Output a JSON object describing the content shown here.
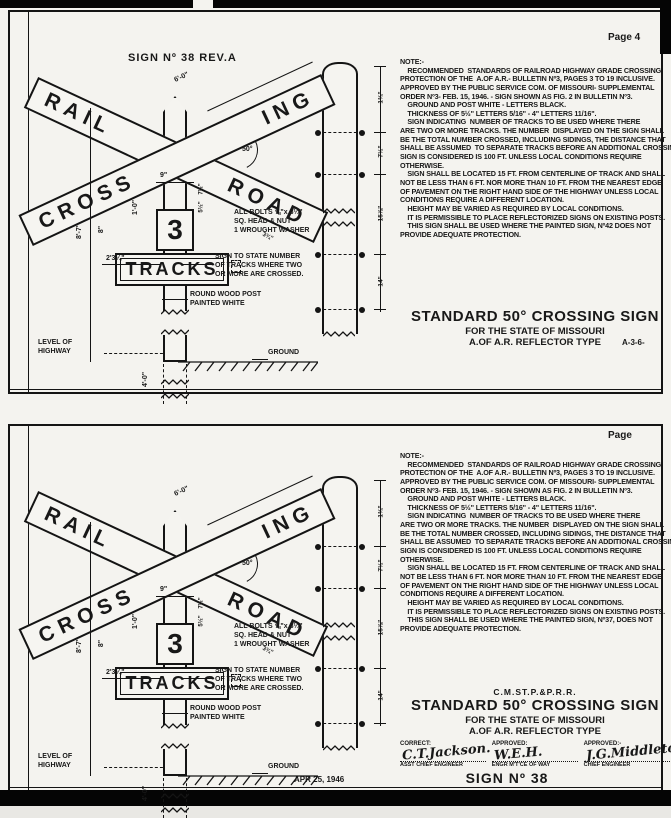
{
  "page_bg": "#f4f3ef",
  "ink": "#141414",
  "panels": [
    {
      "page_label": "Page 4",
      "heading": "SIGN Nº 38 REV.A",
      "crossbuck": {
        "rail": "RAIL",
        "road": "ROAD",
        "cross": "CROSS",
        "ing": "ING",
        "track_count": "3",
        "tracks": "TRACKS"
      },
      "dims": {
        "arm": "6'-0\"",
        "angle": "50°",
        "post_width": "9\"",
        "offset8": "8\"",
        "height": "8'-7\"",
        "base": "2'3¼\"",
        "plate": "1'-0\"",
        "m1": "7½\"",
        "m2": "5½\"",
        "road_end": "3¾\"",
        "below_ground": "4'-0\"",
        "s1": "1¾\"",
        "s2": "7½\"",
        "s3": "15⅞\"",
        "s4": "14\""
      },
      "labels": {
        "bolts": "ALL BOLTS ⅝\"x 8¼\"\nSQ. HEAD & NUT\n1 WROUGHT WASHER",
        "tracks_note": "SIGN TO STATE NUMBER\nOF TRACKS WHERE TWO\nOR MORE ARE CROSSED.",
        "post": "ROUND WOOD POST\nPAINTED WHITE",
        "level": "LEVEL OF\nHIGHWAY",
        "ground": "GROUND"
      },
      "notes": "NOTE:-\n    RECOMMENDED  STANDARDS OF RAILROAD HIGHWAY GRADE CROSSING\nPROTECTION OF THE  A.OF A.R.- BULLETIN Nº3, PAGES 3 TO 19 INCLUSIVE.\nAPPROVED BY THE PUBLIC SERVICE COM. OF MISSOURI- SUPPLEMENTAL\nORDER Nº3- FEB. 15, 1946. - SIGN SHOWN AS FIG. 2 IN BULLETIN Nº3.\n    GROUND AND POST WHITE - LETTERS BLACK.\n    THICKNESS OF 5½\" LETTERS 5/16\" - 4\" LETTERS 11/16\".\n    SIGN INDICATING  NUMBER OF TRACKS TO BE USED WHERE THERE\nARE TWO OR MORE TRACKS. THE NUMBER  DISPLAYED ON THE SIGN SHALL\nBE THE TOTAL NUMBER CROSSED, INCLUDING SIDINGS, THE DISTANCE THAT\nSHALL BE ASSUMED  TO SEPARATE TRACKS BEFORE AN ADDITIONAL CROSSING\nSIGN IS CONSIDERED IS 100 FT. UNLESS LOCAL CONDITIONS REQUIRE\nOTHERWISE.\n    SIGN SHALL BE LOCATED 15 FT. FROM CENTERLINE OF TRACK AND SHALL\nNOT BE LESS THAN 6 FT. NOR MORE THAN 10 FT. FROM THE NEAREST EDGE\nOF PAVEMENT ON THE RIGHT HAND SIDE OF THE HIGHWAY UNLESS LOCAL\nCONDITIONS REQUIRE A DIFFERENT LOCATION.\n    HEIGHT MAY BE VARIED AS REQUIRED BY LOCAL CONDITIONS.\n    IT IS PERMISSIBLE TO PLACE REFLECTORIZED SIGNS ON EXISTING POSTS.\n    THIS SIGN SHALL BE USED WHERE THE PAINTED SIGN, Nº42 DOES NOT\nPROVIDE ADEQUATE PROTECTION.",
      "title": {
        "rr": "",
        "line1": "STANDARD 50° CROSSING SIGN",
        "line2": "FOR THE STATE OF MISSOURI",
        "line3": "A.OF A.R. REFLECTOR TYPE",
        "code": "A-3-6-"
      }
    },
    {
      "page_label": "Page",
      "heading": "",
      "crossbuck": {
        "rail": "RAIL",
        "road": "ROAD",
        "cross": "CROSS",
        "ing": "ING",
        "track_count": "3",
        "tracks": "TRACKS"
      },
      "dims": {
        "arm": "6'-0\"",
        "angle": "50°",
        "post_width": "9\"",
        "offset8": "8\"",
        "height": "8'-7\"",
        "base": "2'3¼\"",
        "plate": "1'-0\"",
        "m1": "7½\"",
        "m2": "5½\"",
        "road_end": "3¾\"",
        "below_ground": "4'-0\"",
        "s1": "1¾\"",
        "s2": "7½\"",
        "s3": "15⅞\"",
        "s4": "14\""
      },
      "labels": {
        "bolts": "ALL BOLTS ⅝\"x 8¼\"\nSQ. HEAD & NUT\n1 WROUGHT WASHER",
        "tracks_note": "SIGN TO STATE NUMBER\nOF TRACKS WHERE TWO\nOR MORE ARE CROSSED.",
        "post": "ROUND WOOD POST\nPAINTED WHITE",
        "level": "LEVEL OF\nHIGHWAY",
        "ground": "GROUND"
      },
      "notes": "NOTE:-\n    RECOMMENDED  STANDARDS OF RAILROAD HIGHWAY GRADE CROSSING\nPROTECTION OF THE  A.OF A.R.- BULLETIN Nº3, PAGES 3 TO 19 INCLUSIVE.\nAPPROVED BY THE PUBLIC SERVICE COM. OF MISSOURI- SUPPLEMENTAL\nORDER Nº3- FEB. 15, 1946. - SIGN SHOWN AS FIG. 2 IN BULLETIN Nº3.\n    GROUND AND POST WHITE - LETTERS BLACK.\n    THICKNESS OF 5½\" LETTERS 5/16\" - 4\" LETTERS 11/16\".\n    SIGN INDICATING  NUMBER OF TRACKS TO BE USED WHERE THERE\nARE TWO OR MORE TRACKS. THE NUMBER  DISPLAYED ON THE SIGN SHALL\nBE THE TOTAL NUMBER CROSSED, INCLUDING SIDINGS, THE DISTANCE THAT\nSHALL BE ASSUMED  TO SEPARATE TRACKS BEFORE AN ADDITIONAL CROSSING\nSIGN IS CONSIDERED IS 100 FT. UNLESS LOCAL CONDITIONS REQUIRE\nOTHERWISE.\n    SIGN SHALL BE LOCATED 15 FT. FROM CENTERLINE OF TRACK AND SHALL\nNOT BE LESS THAN 6 FT. NOR MORE THAN 10 FT. FROM THE NEAREST EDGE\nOF PAVEMENT ON THE RIGHT HAND SIDE OF THE HIGHWAY UNLESS LOCAL\nCONDITIONS REQUIRE A DIFFERENT LOCATION.\n    HEIGHT MAY BE VARIED AS REQUIRED BY LOCAL CONDITIONS.\n    IT IS PERMISSIBLE TO PLACE REFLECTORIZED SIGNS ON EXISTING POSTS.\n    THIS SIGN SHALL BE USED WHERE THE PAINTED SIGN, Nº37, DOES NOT\nPROVIDE ADEQUATE PROTECTION.",
      "title": {
        "rr": "C.M.ST.P.&P.R.R.",
        "line1": "STANDARD 50° CROSSING SIGN",
        "line2": "FOR THE STATE OF MISSOURI",
        "line3": "A.OF A.R. REFLECTOR TYPE",
        "code": ""
      },
      "approvals": {
        "correct_label": "CORRECT:",
        "correct_sig": "C.T.Jackson.",
        "correct_title": "ASST CHIEF ENGINEER",
        "approved1_label": "APPROVED:",
        "approved1_sig": "W.E.H.",
        "approved1_title": "ENGR M'T'CE OF WAY",
        "approved2_label": "APPROVED:-",
        "approved2_sig": "J.G.Middleton",
        "approved2_title": "CHIEF ENGINEER",
        "sign_no": "SIGN Nº 38",
        "date": "APR 25, 1946"
      }
    }
  ]
}
